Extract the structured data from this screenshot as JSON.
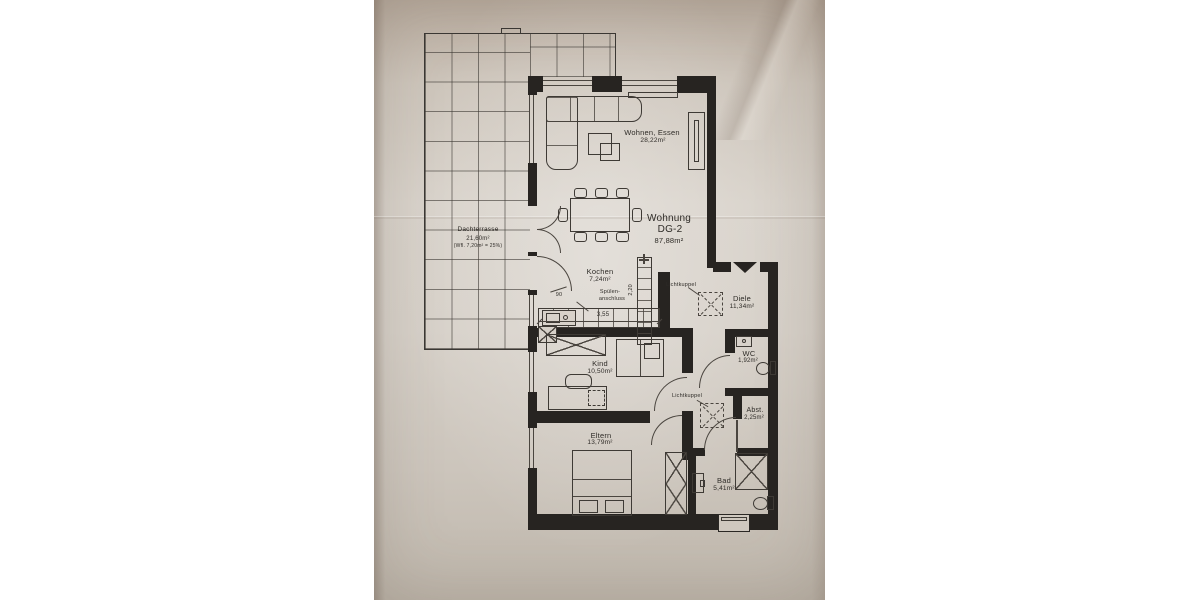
{
  "apartment": {
    "title": "Wohnung",
    "unit": "DG-2",
    "area": "87,88m²"
  },
  "rooms": {
    "wohnen": {
      "name": "Wohnen, Essen",
      "area": "28,22m²"
    },
    "terrasse": {
      "name": "Dachterrasse",
      "area": "21,60m²",
      "note": "(Wfl. 7,20m² = 25%)"
    },
    "kochen": {
      "name": "Kochen",
      "area": "7,24m²"
    },
    "diele": {
      "name": "Diele",
      "area": "11,34m²"
    },
    "wc": {
      "name": "WC",
      "area": "1,92m²"
    },
    "kind": {
      "name": "Kind",
      "area": "10,50m²"
    },
    "abst": {
      "name": "Abst.",
      "area": "2,25m²"
    },
    "eltern": {
      "name": "Eltern",
      "area": "13,79m²"
    },
    "bad": {
      "name": "Bad",
      "area": "5,41m²"
    }
  },
  "annotations": {
    "skylight1": "Lichtkuppel",
    "skylight2": "Lichtkuppel",
    "sink_l1": "Spülen-",
    "sink_l2": "anschluss"
  },
  "dimensions": {
    "kitchen_width": "3,55",
    "kitchen_depth": "2,20",
    "door_width": "90"
  },
  "colors": {
    "wall": "#272421",
    "line": "#4a453f",
    "paper": "#d6d0c8"
  }
}
